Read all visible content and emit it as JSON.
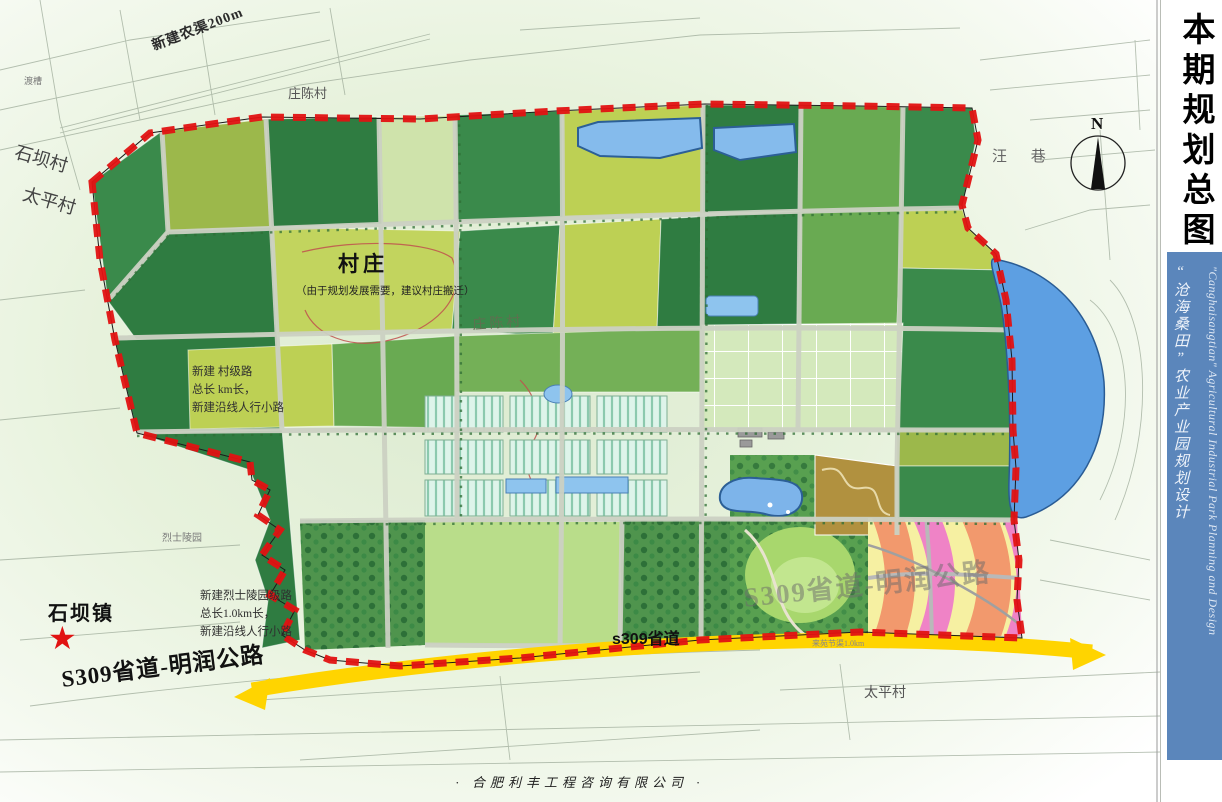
{
  "sidebar": {
    "title": "本期规划总图",
    "subtitle_cn": "“沧海桑田”农业产业园规划设计",
    "subtitle_en": "\"Canghaisangtian\" Agricultural Industrial Park Planning and Design",
    "accent_blue": "#5b86bb"
  },
  "footer": {
    "credit": "·  合肥利丰工程咨询有限公司  ·"
  },
  "compass": {
    "label": "N"
  },
  "icons": {
    "town_star": "★"
  },
  "labels": {
    "canal_top": "新建农渠200m",
    "aqueduct": "渡槽",
    "village_zhuangchen_top": "庄陈村",
    "village_shiba": "石坝村",
    "village_taiping_left": "太平村",
    "village_wangxiang": "汪  巷",
    "village_cluster_title": "村庄",
    "village_cluster_note": "（由于规划发展需要，建议村庄搬迁）",
    "village_zhuangchen_mid": "庄陈村",
    "road_note_mid": "新建 村级路\n总长 km长，\n新建沿线人行小路",
    "martyr_cemetery": "烈士陵园",
    "road_note_south": "新建烈士陵园级路\n总长1.0km长，\n新建沿线人行小路",
    "town_shiba": "石坝镇",
    "s309_full_left": "S309省道-明润公路",
    "s309_band": "s309省道",
    "s309_full_ghost": "S309省道-明润公路",
    "village_taiping_bottom": "太平村",
    "canal_bottom": "来苑节渠1.0km"
  },
  "palette": {
    "boundary_red": "#e11212",
    "provincial_road_yellow": "#ffd400",
    "pond_blue": "#7db4ea",
    "lake_blue": "#5d9fe2",
    "greenhouse_mint": "#def4ea",
    "orchard_tan": "#b1913f",
    "leisure_pink": "#ef83c6",
    "leisure_salmon": "#f2996d",
    "leisure_yellow": "#f6f0a2"
  }
}
